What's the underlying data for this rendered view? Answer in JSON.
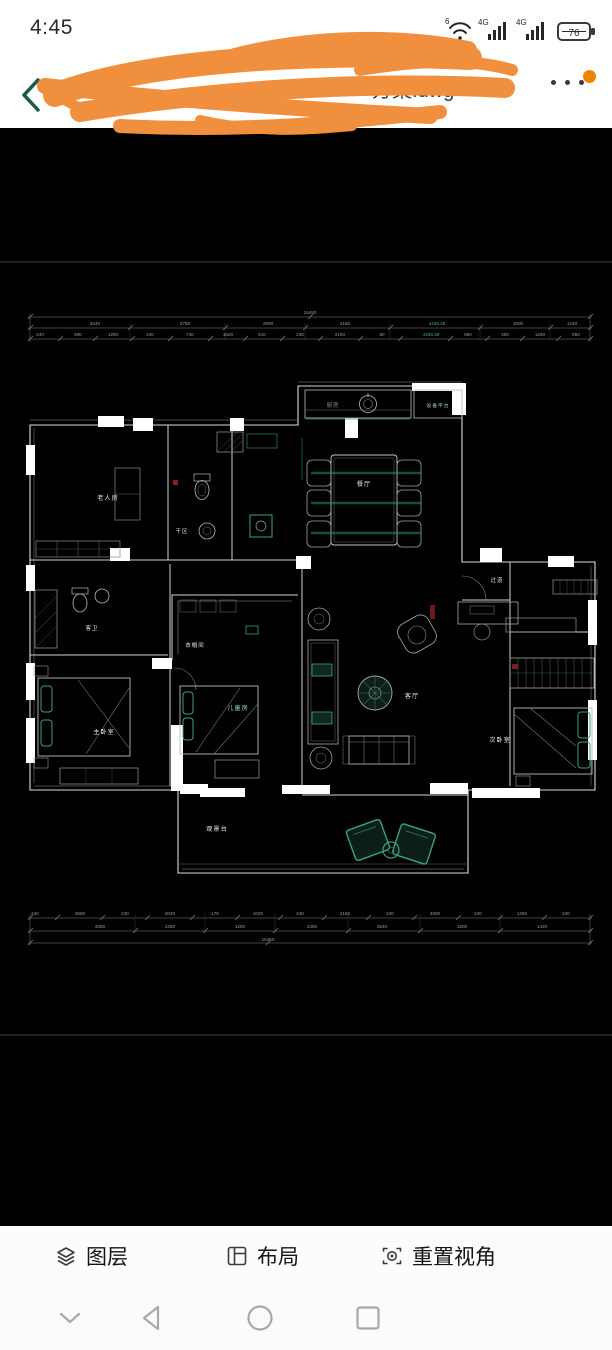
{
  "status_bar": {
    "time": "4:45",
    "wifi_badge": "6",
    "network_badge_1": "4G",
    "network_badge_2": "4G",
    "battery_level": "76"
  },
  "header": {
    "title_partial": "方案.dwg",
    "watermark_partial": "Q QIN",
    "menu_icon": "more-dots",
    "back_icon": "back-chevron"
  },
  "floor_plan": {
    "rooms": {
      "kitchen": "厨房",
      "equipment_platform": "设备平台",
      "dining": "餐厅",
      "elder_room": "老人房",
      "dry_area": "干区",
      "guest_bath": "客卫",
      "cloakroom": "衣帽间",
      "master_bedroom": "主卧室",
      "kids_room": "儿童房",
      "living_room": "客厅",
      "hallway": "过道",
      "second_bedroom": "次卧室",
      "balcony": "观景台"
    },
    "dims": {
      "top_total": "16450",
      "top_row2": [
        "3240",
        "2750",
        "2600",
        "2150",
        "4438.38",
        "1500",
        "1240"
      ],
      "top_row3": [
        "240",
        "900",
        "1260",
        "240",
        "740",
        "1500",
        "610",
        "240",
        "2150",
        "80",
        "4438.38",
        "960",
        "300",
        "1260",
        "850"
      ],
      "bottom_row1": [
        "240",
        "3060",
        "240",
        "2040",
        "170",
        "1020",
        "240",
        "2150",
        "240",
        "3300",
        "240",
        "1260",
        "240"
      ],
      "bottom_row2": [
        "3300",
        "2280",
        "1260",
        "2390",
        "3540",
        "1500",
        "1420"
      ],
      "bottom_total": "16450"
    }
  },
  "toolbar": {
    "items": [
      {
        "icon": "layers-icon",
        "label": "图层"
      },
      {
        "icon": "layout-icon",
        "label": "布局"
      },
      {
        "icon": "reset-view-icon",
        "label": "重置视角"
      }
    ]
  },
  "nav_bar": {
    "icons": [
      "chevron-down",
      "back-triangle",
      "home-circle",
      "recents-square"
    ]
  },
  "colors": {
    "accent_teal": "#3da183",
    "scribble_orange": "#f0903e",
    "badge_orange": "#f08300",
    "canvas_bg": "#000000"
  }
}
